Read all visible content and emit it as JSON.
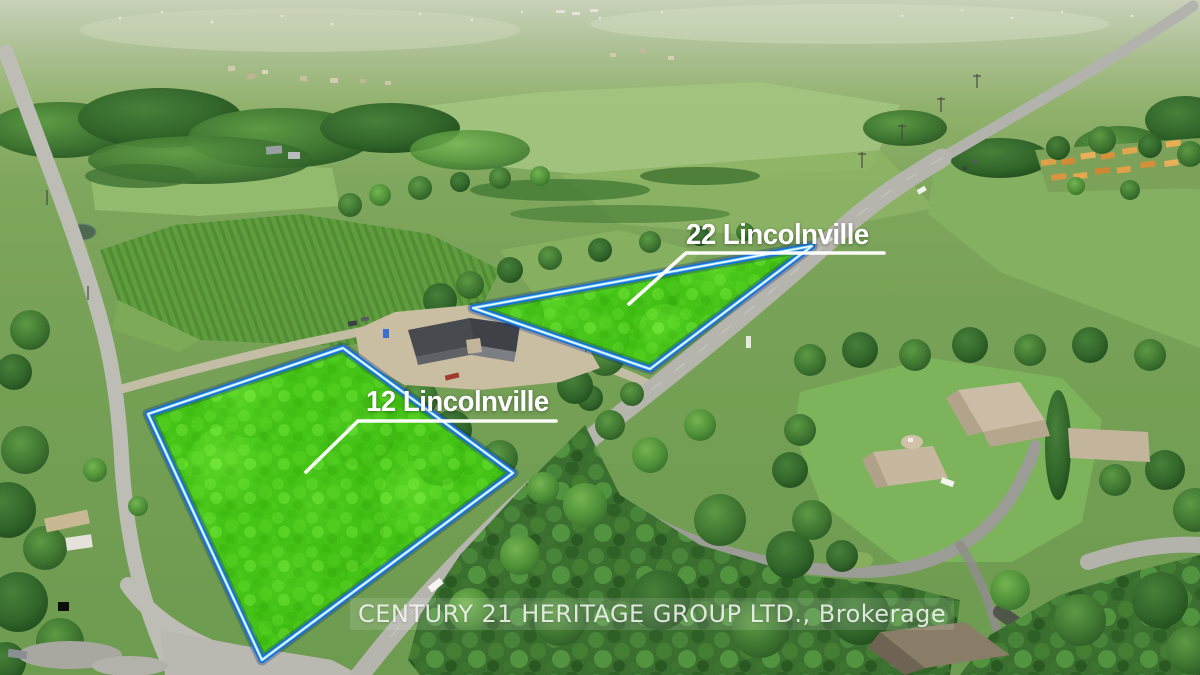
{
  "scene": {
    "description": "Aerial drone photograph of rural countryside with two vacant land parcels highlighted in bright green and outlined in blue beside a diagonal country road"
  },
  "parcels": [
    {
      "label": "22 Lincolnville"
    },
    {
      "label": "12 Lincolnville"
    }
  ],
  "watermark": {
    "text": "CENTURY 21 HERITAGE GROUP LTD., Brokerage"
  },
  "colors": {
    "highlight-green": "#45c417",
    "highlight-green-light": "#6ee637",
    "outline-blue": "#1c6cd6",
    "outline-cyan": "#55c6f2",
    "outline-glow": "#0a2f7e",
    "outline-white": "#ffffff",
    "label-white": "#ffffff",
    "road-gray": "#b5b5ae",
    "gravel-tan": "#c6bfa9",
    "dirt-tan": "#c9bda2",
    "field-green": "#7fa75d",
    "forest-green": "#3b6f2f"
  }
}
